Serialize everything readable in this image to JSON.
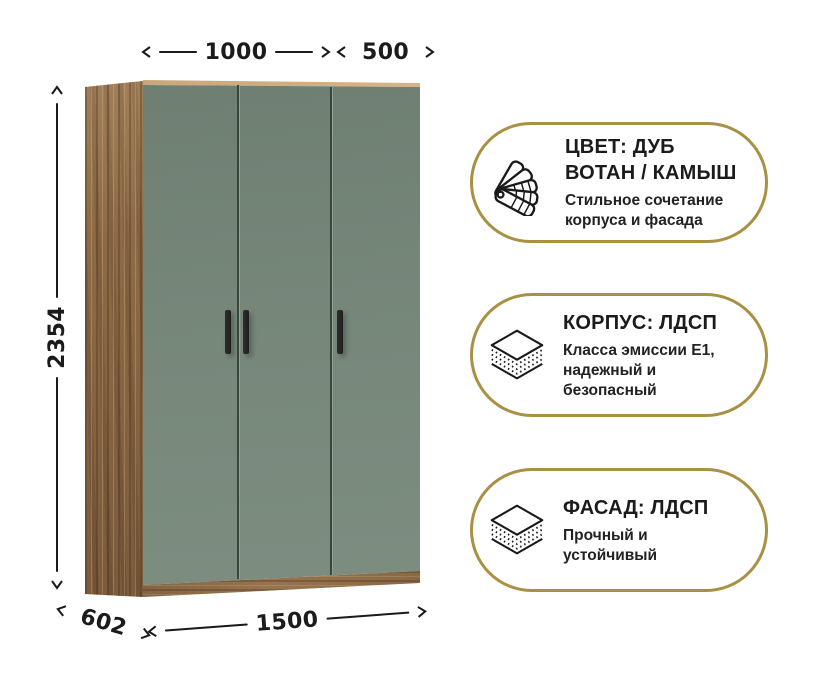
{
  "colors": {
    "background": "#ffffff",
    "line": "#1a1a1a",
    "text": "#1b1b1b",
    "badge-border": "#a99144",
    "door-green": "#76877a",
    "door-green-dark": "#6e7f72",
    "door-gap": "#3a463d",
    "wood-base": "#97744e",
    "wood-light": "#b4946c",
    "wood-dark": "#7b5c3e",
    "wood-top": "#c8a578",
    "handle": "#1f1f1f"
  },
  "dimensions": {
    "width_left_doors": "1000",
    "width_right_door": "500",
    "height": "2354",
    "depth": "602",
    "width_total": "1500"
  },
  "badges": [
    {
      "icon": "color-swatch-fan",
      "title": "ЦВЕТ: ДУБ\nВОТАН / КАМЫШ",
      "subtitle": "Стильное сочетание\nкорпуса и фасада"
    },
    {
      "icon": "layers",
      "title": "КОРПУС: ЛДСП",
      "subtitle": "Класса эмиссии Е1,\nнадежный и\nбезопасный"
    },
    {
      "icon": "layers",
      "title": "ФАСАД: ЛДСП",
      "subtitle": "Прочный и\nустойчивый"
    }
  ]
}
